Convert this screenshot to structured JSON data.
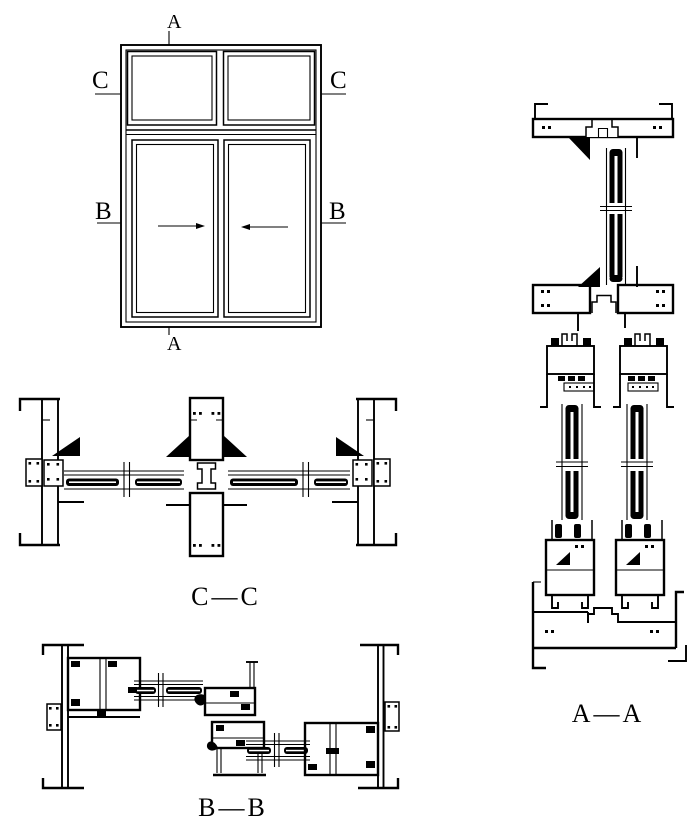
{
  "drawing": {
    "background_color": "#ffffff",
    "line_color": "#000000",
    "elevation": {
      "marker_top": "A",
      "marker_bottom": "A",
      "marker_left_upper": "C",
      "marker_right_upper": "C",
      "marker_left_lower": "B",
      "marker_right_lower": "B",
      "slide_arrows": [
        "right",
        "left"
      ]
    },
    "section_labels": {
      "cc": "C—C",
      "bb": "B—B",
      "aa": "A—A"
    }
  }
}
